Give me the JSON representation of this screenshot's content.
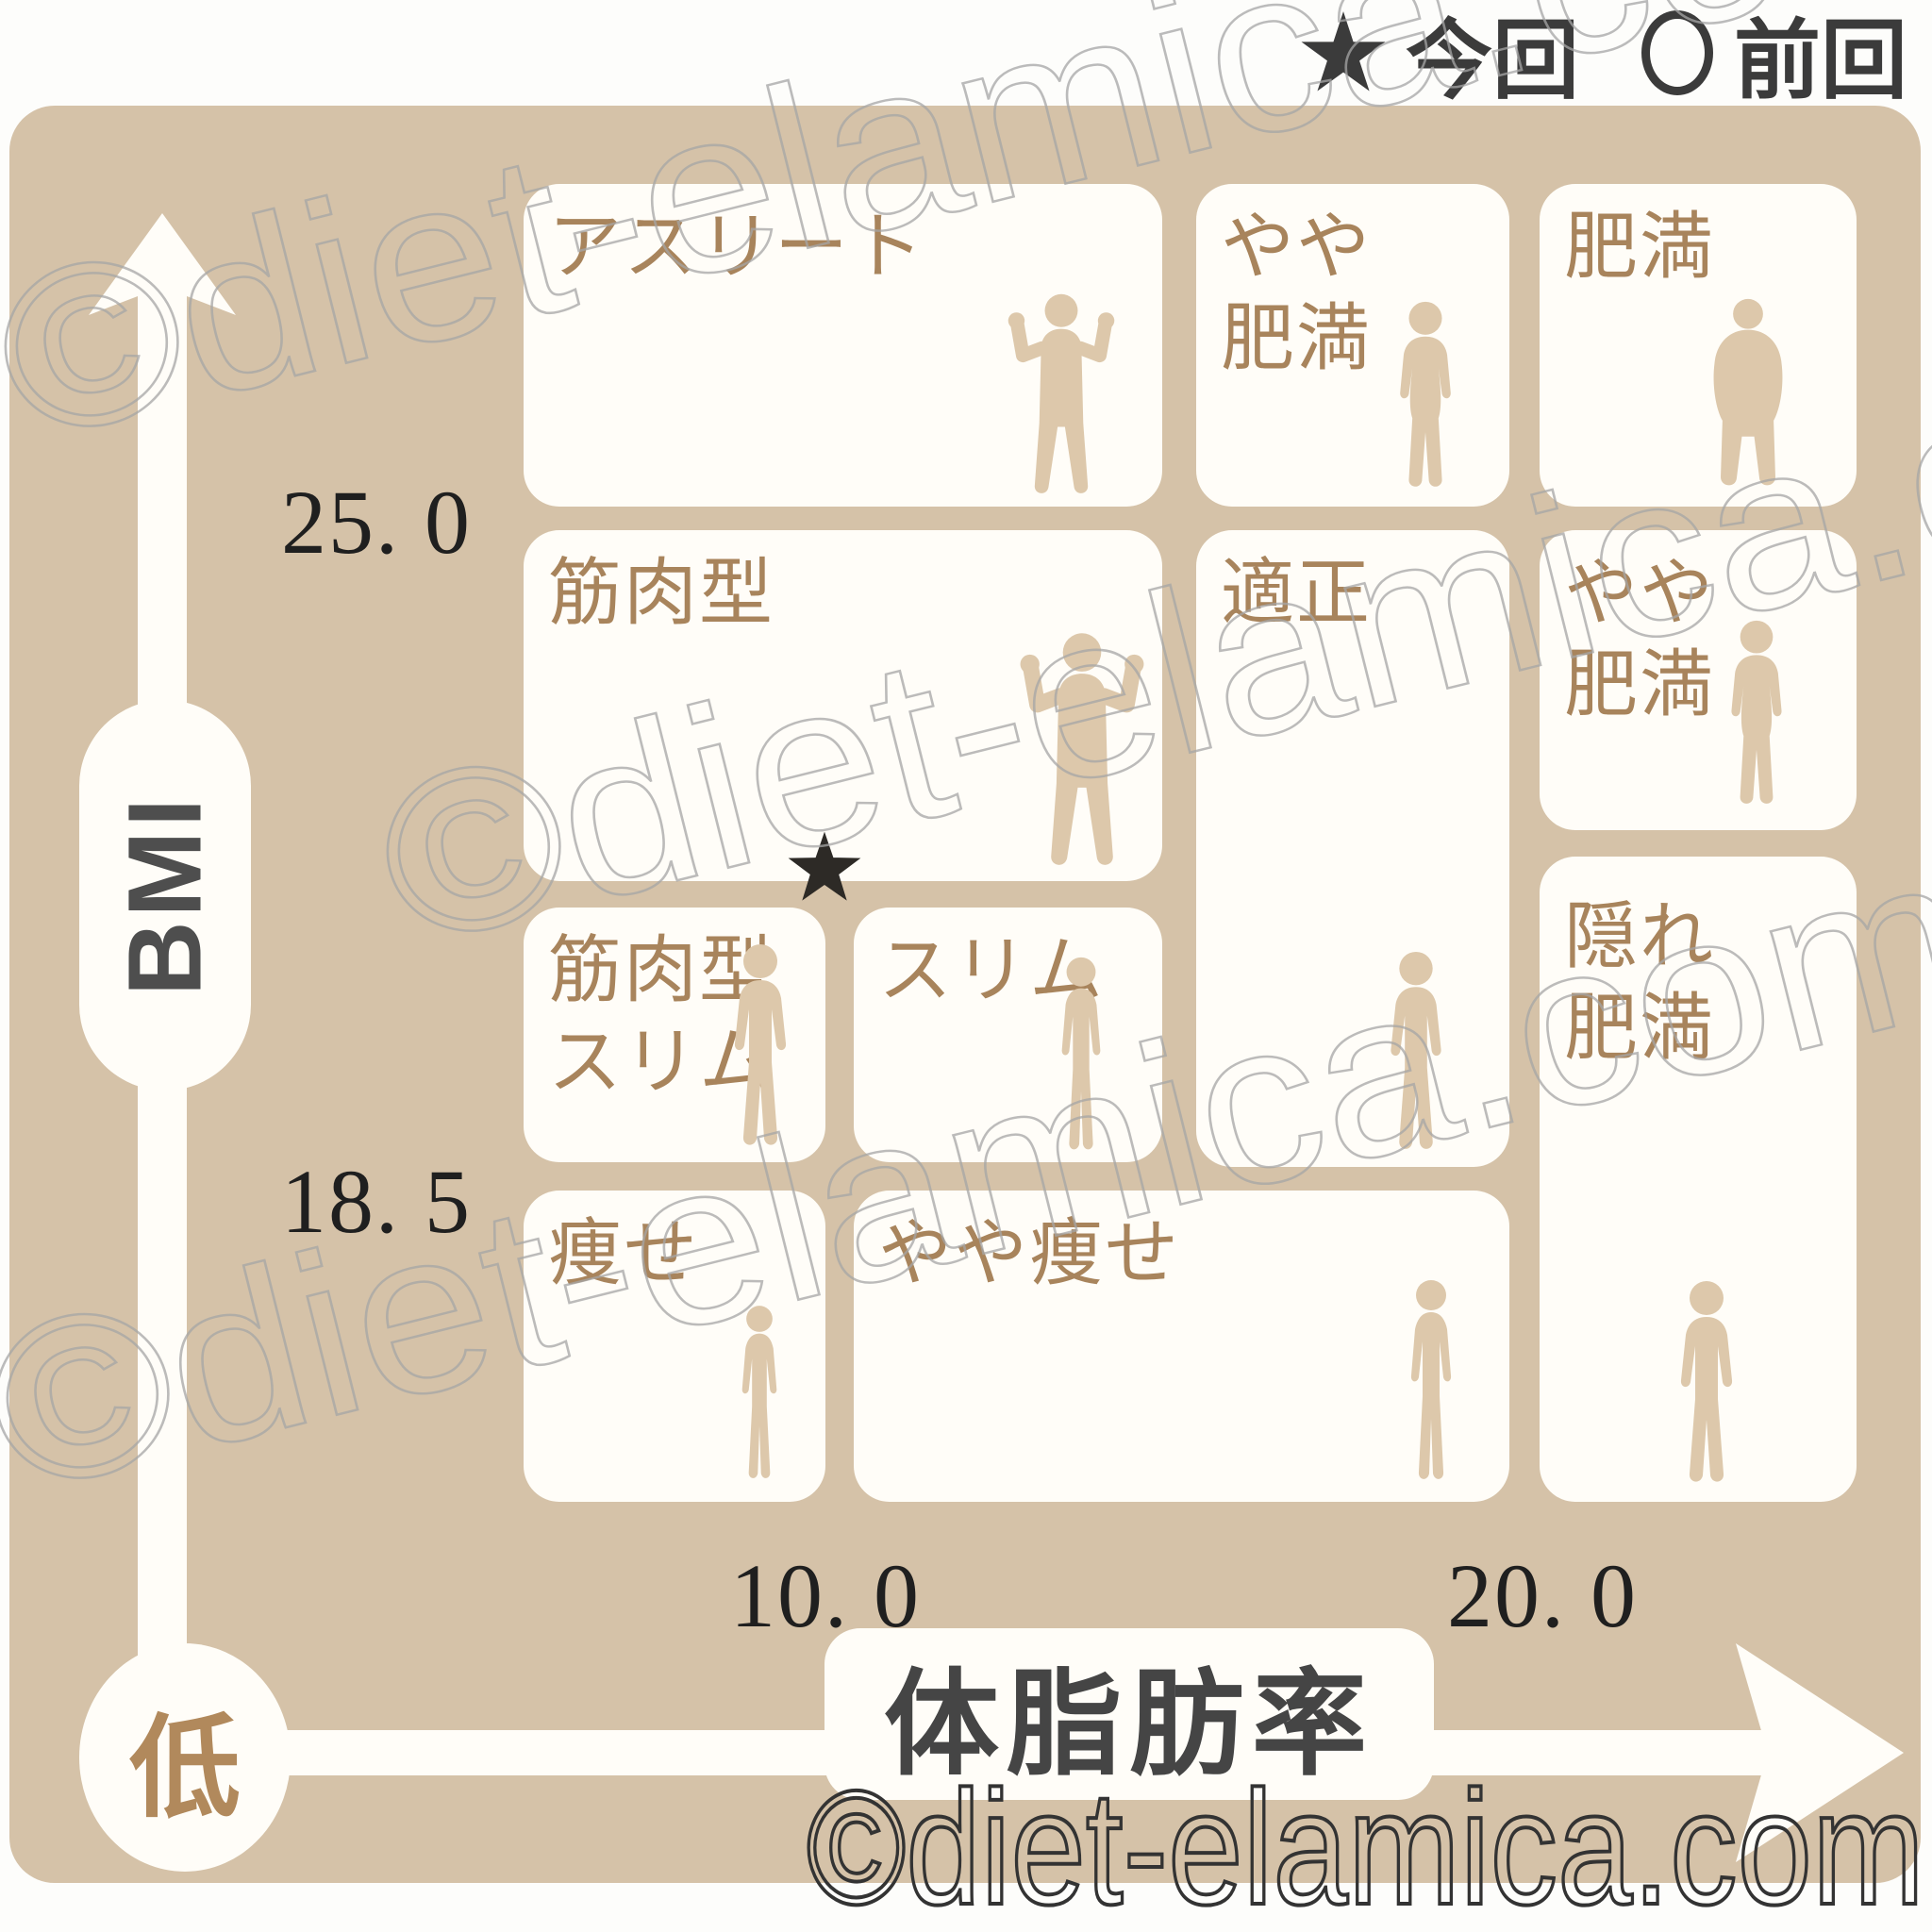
{
  "legend": {
    "current": {
      "symbol": "★",
      "label": "今回"
    },
    "previous": {
      "symbol": "○",
      "label": "前回"
    }
  },
  "axis_y": {
    "label": "BMI",
    "ticks": {
      "t25": "25. 0",
      "t185": "18. 5"
    }
  },
  "axis_x": {
    "label": "体脂肪率",
    "origin": "低",
    "ticks": {
      "t10": "10. 0",
      "t20": "20. 0"
    }
  },
  "cells": {
    "athlete": {
      "label": "アスリート"
    },
    "slightly_obese_top": {
      "lines": [
        "やや",
        "肥満"
      ]
    },
    "obese": {
      "label": "肥満"
    },
    "muscular": {
      "label": "筋肉型"
    },
    "appropriate": {
      "label": "適正"
    },
    "slightly_obese_right": {
      "lines": [
        "やや",
        "肥満"
      ]
    },
    "muscular_slim": {
      "lines": [
        "筋肉型",
        "スリム"
      ]
    },
    "slim": {
      "label": "スリム"
    },
    "hidden_obese": {
      "lines": [
        "隠れ",
        "肥満"
      ]
    },
    "thin": {
      "label": "痩せ"
    },
    "slightly_thin": {
      "label": "やや痩せ"
    }
  },
  "marker": {
    "symbol": "★",
    "label": "今回",
    "body_fat_pct": 10.0,
    "bmi_approx": 21.5
  },
  "watermark": {
    "text": "©diet-elamica.com"
  },
  "colors": {
    "panel_beige": "#d5c2a8",
    "cell_white": "#fffdf8",
    "figure_tan": "#ddc8ab",
    "label_brown": "#a8845c",
    "star_black": "#2d2a26",
    "axis_text": "#1f1f1f",
    "watermark_dark": "#333333"
  },
  "chart_data": {
    "type": "heatmap",
    "title": "BMI × 体脂肪率 体型判定チャート",
    "xlabel": "体脂肪率",
    "ylabel": "BMI",
    "x_ticks": [
      10.0,
      20.0
    ],
    "y_ticks": [
      18.5,
      25.0
    ],
    "x_origin_label": "低",
    "grid": false,
    "legend_position": "top-right",
    "legend_entries": [
      "★今回",
      "○前回"
    ],
    "zones": [
      {
        "label": "アスリート",
        "bmi": ">25.0",
        "body_fat": "<~15"
      },
      {
        "label": "やや肥満",
        "bmi": ">25.0",
        "body_fat": "~15-20.0"
      },
      {
        "label": "肥満",
        "bmi": ">25.0",
        "body_fat": ">20.0"
      },
      {
        "label": "筋肉型",
        "bmi": "~21.5-25.0",
        "body_fat": "<~15"
      },
      {
        "label": "適正",
        "bmi": "18.5-25.0",
        "body_fat": "~15-20.0"
      },
      {
        "label": "やや肥満",
        "bmi": "~22-25.0",
        "body_fat": ">20.0"
      },
      {
        "label": "筋肉型スリム",
        "bmi": "18.5-21.5",
        "body_fat": "<10.0"
      },
      {
        "label": "スリム",
        "bmi": "18.5-21.5",
        "body_fat": "10.0-~15"
      },
      {
        "label": "隠れ肥満",
        "bmi": "<~22",
        "body_fat": ">20.0"
      },
      {
        "label": "痩せ",
        "bmi": "<18.5",
        "body_fat": "<10.0"
      },
      {
        "label": "やや痩せ",
        "bmi": "<18.5",
        "body_fat": "10.0-20.0"
      }
    ],
    "markers": [
      {
        "symbol": "★",
        "name": "今回",
        "body_fat": 10.0,
        "bmi": 21.5,
        "visible": true
      },
      {
        "symbol": "○",
        "name": "前回",
        "visible": false
      }
    ]
  }
}
